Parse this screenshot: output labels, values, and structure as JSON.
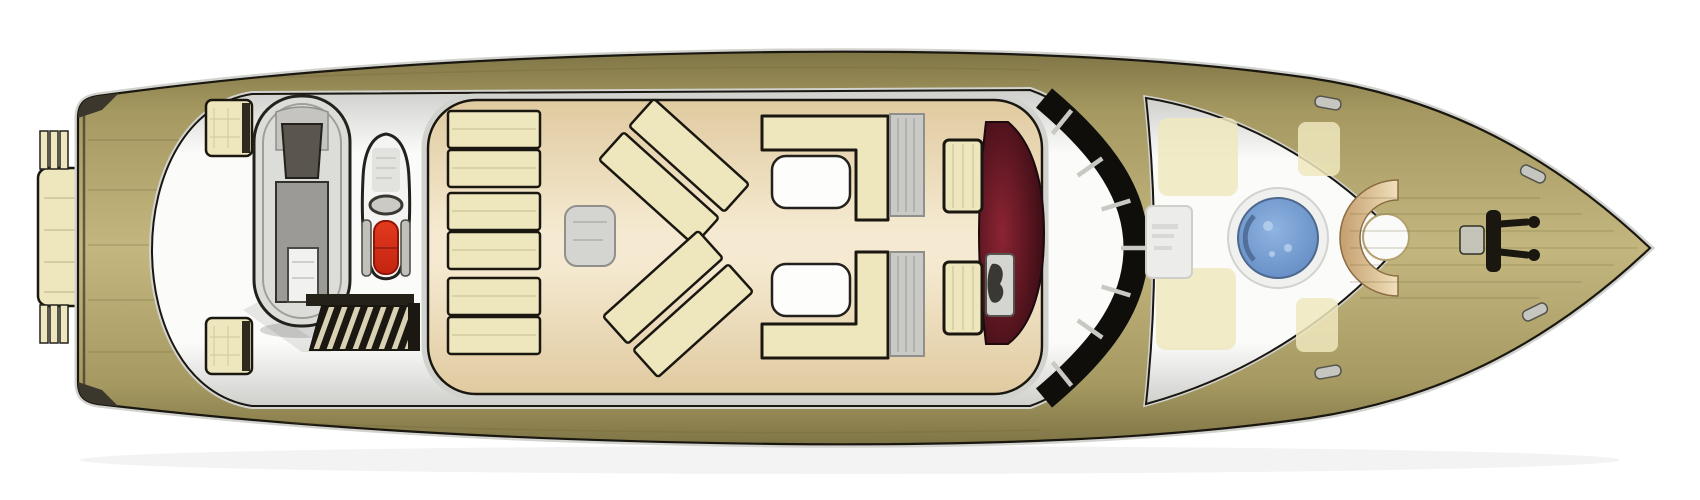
{
  "vessel": {
    "label": "Motor yacht deck plan, top-down view, bow pointing right",
    "view": "top-down",
    "bow_direction": "right"
  },
  "palette": {
    "bg": "#ffffff",
    "hull_edge": "#7f7445",
    "hull_mid": "#a59961",
    "hull_light": "#c3b77f",
    "trim": "#1a1710",
    "shadow": "#3b372c",
    "deck_white": "#fbfbfa",
    "deck_white_edge": "#cfcfcc",
    "floor_tan": "#f5ead1",
    "floor_tan_edge": "#e0caa0",
    "cushion": "#eee7bd",
    "table_white": "#fdfdfc",
    "table_gray": "#d4d4d1",
    "grate": "#c9c9c5",
    "tender_hull": "#dcdcd8",
    "tender_floor": "#9c9a96",
    "tender_dark": "#57544e",
    "jetski_white": "#f4f4f2",
    "seat_red": "#e23a1e",
    "seat_red_deep": "#c42410",
    "tread_dark": "#1b1811",
    "tread_light": "#d8d1b3",
    "cockpit_red": "#8c2433",
    "cockpit_red_edge": "#310a11",
    "glass": "#0f0e0b",
    "mullion": "#c9c9c4",
    "pool_center": "#8fb4e2",
    "pool_edge": "#6088c0",
    "pool_ring": "#48648c",
    "pool_rim": "#f0f0ee",
    "pool_speckle": "#b9d2ee",
    "bronze": "#c49e6e",
    "bronze_light": "#f0e0ba",
    "frost": "#ececea",
    "metal": "#c6c6c0",
    "engine_box": "#f1f1ef",
    "windshield_gray": "#5a564e"
  },
  "features": {
    "swim_platform": {
      "label": "Swim platform"
    },
    "transom_steps": {
      "label": "Transom steps",
      "count": 2
    },
    "storage_boxes": {
      "label": "Aft deck storage boxes",
      "count": 2
    },
    "tender": {
      "label": "Tender (dinghy) stowed on aft deck"
    },
    "jet_ski": {
      "label": "Jet ski with red seat"
    },
    "companionway": {
      "label": "Companionway stairs",
      "treads": 8
    },
    "sun_loungers": {
      "label": "Sun lounger pads",
      "count": 6
    },
    "angled_sunpads": {
      "label": "Angled sun pads",
      "count": 4
    },
    "side_table": {
      "label": "Side table"
    },
    "dinettes": {
      "label": "L-shaped settees with tables",
      "count": 2
    },
    "walkway_grates": {
      "label": "Walk-through grates",
      "count": 2
    },
    "helm_seats": {
      "label": "Helm seats",
      "count": 2
    },
    "helm_console": {
      "label": "Helm console"
    },
    "cockpit_well": {
      "label": "Dark red helm cockpit well"
    },
    "windscreen": {
      "label": "Wrap-around windscreen",
      "mullions": 7
    },
    "foredeck": {
      "label": "Foredeck"
    },
    "deck_hatch": {
      "label": "Frosted deck hatch"
    },
    "spa_pool": {
      "label": "Round spa pool"
    },
    "bow_sunpad": {
      "label": "Crescent bow sun pad"
    },
    "bow_table": {
      "label": "Round bow table"
    },
    "windlass": {
      "label": "Anchor windlass"
    },
    "cleats": {
      "label": "Mooring cleats",
      "count": 4
    }
  }
}
